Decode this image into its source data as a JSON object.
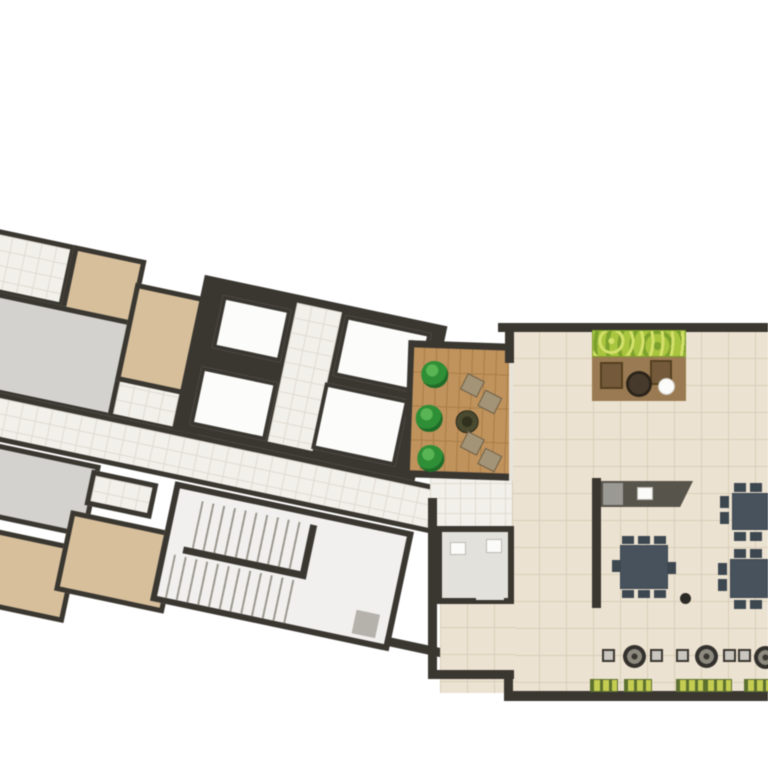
{
  "palette": {
    "bg": "#ffffff",
    "wall": "#3a3731",
    "tile": "#f2f0ea",
    "tile_line": "#dfdbd2",
    "tan": "#d7bf9b",
    "gray_room": "#d3d2cf",
    "shaft": "#fcfcfb",
    "cream": "#ece2d1",
    "cream_line": "#d9cdb7",
    "wood": "#c0925c",
    "wood_line": "#a97e48",
    "bush": "#2f8f36",
    "bush_light": "#59b554",
    "bush_dark": "#1f6b28",
    "patio": "#a39478",
    "patio_dark": "#6f5f43",
    "hedge": "#a9c43f",
    "hedge_light": "#d3e06a",
    "hedge_dark": "#7da12e",
    "rug": "#9a7a52",
    "armchair": "#745a3b",
    "armchair_dark": "#54401f",
    "counter": "#57544c",
    "appliance": "#9b9993",
    "slate": "#47525c",
    "slate_dark": "#3d4750",
    "lounger": "#c4cc52",
    "lounger_stripe": "#5d7030",
    "stool": "#c9c6bf",
    "wc_floor": "#e3e1dc",
    "fixture": "#fbfbf9",
    "mat": "#b5b2ab",
    "stair_tread": "#9b998f",
    "glass": "#e8e4da",
    "firepit": "#4a4a30",
    "firepit_dark": "#30301e"
  },
  "inventory": {
    "residential_wing": {
      "bedrooms": 4,
      "living_rooms": 2,
      "bathrooms": 3,
      "elevator_shafts": 4,
      "stair_flights": 2,
      "corridors": 1
    },
    "terrace_deck": {
      "shrubs": 3,
      "patio_seat_sets": 2,
      "planter_fire_pit": 1
    },
    "amenity_hall": {
      "hedge_planters": 1,
      "lounge_armchairs": 2,
      "lounge_tables": 2,
      "wc_rooms": 1,
      "kitchen_counters": 1,
      "kitchen_tables": 1,
      "communal_tables": 2,
      "bistro_tables": 3,
      "stools": 5,
      "sun_loungers": 5
    }
  }
}
